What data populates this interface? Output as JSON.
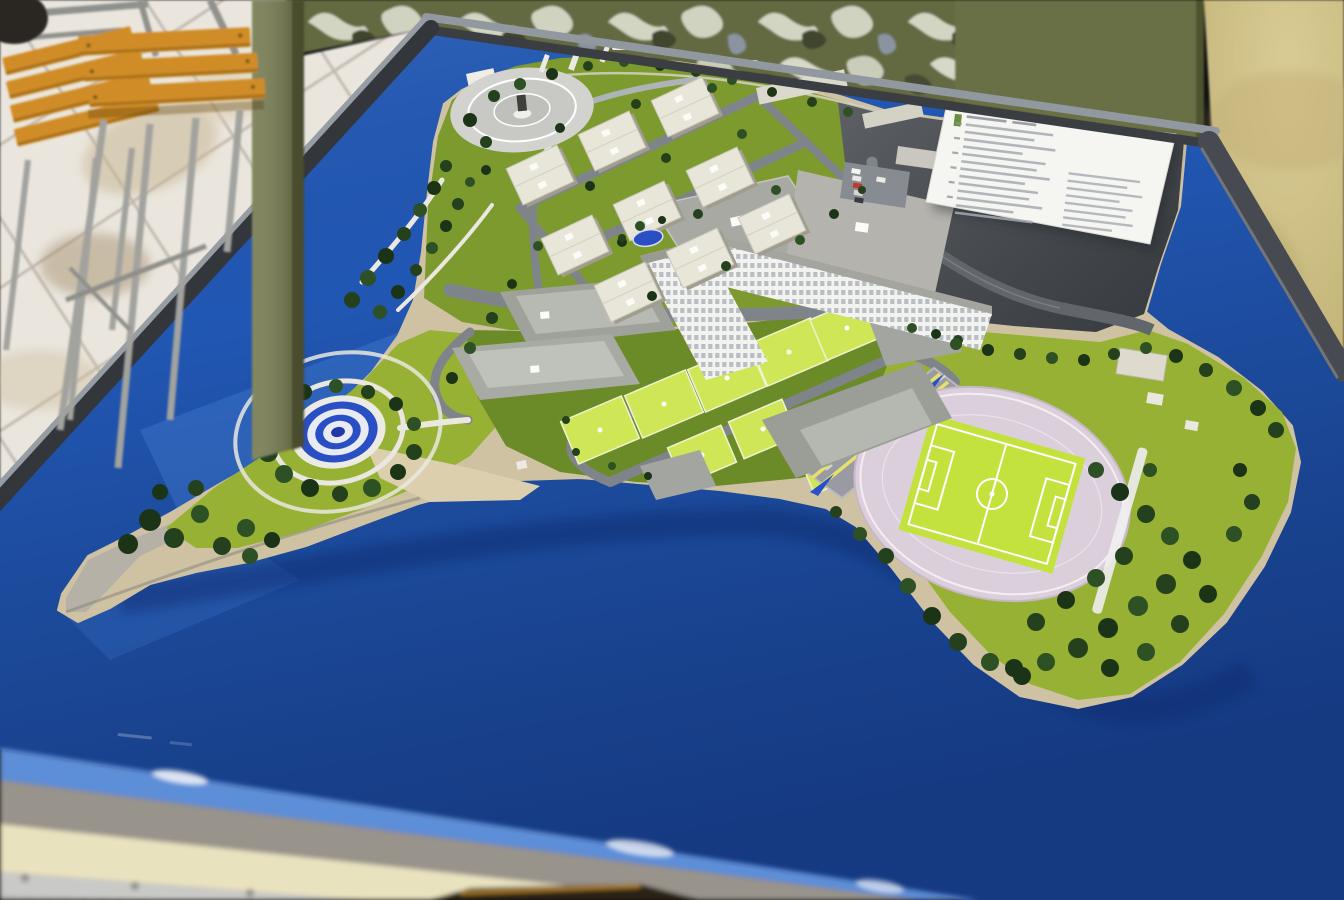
{
  "scene": {
    "type": "photograph",
    "subject": "architectural scale model of a coastal military campus displayed on a blue-topped exhibition table",
    "background_elements": [
      "camouflage curtain",
      "olive wall panel",
      "wooden folding stools",
      "tiled floor",
      "beige floor"
    ],
    "model_features": {
      "water": "deep blue bay surrounding a peninsula",
      "parade_circle": "light gray circular plaza with central monument",
      "fountain": "circular pool with concentric blue and white rings, ringed by trees",
      "stadium": "oval running track with bright green soccer pitch and white markings",
      "drill_strip": "straight gray track with yellow lane lines and blue direction arrows",
      "legend_card": "white tilted information card with fine illegible text rows",
      "barracks_count": 9,
      "sports_courts_count": 9,
      "headquarters_slabs": 2,
      "large_halls": 4,
      "piers_count": 3,
      "boats_count": 5,
      "parked_cars_count": 6
    }
  },
  "palette": {
    "water": "#2157b4",
    "water_glint": "#eef3fa",
    "land_sand": "#cfc2a3",
    "quay": "#b6b1a7",
    "grass_bright": "#97b134",
    "grass_mid": "#7d9a2e",
    "grass_dark": "#6b8a28",
    "court": "#cfe657",
    "pitch": "#c3e23e",
    "track": "#dccfdc",
    "asphalt": "#4c5055",
    "road": "#7f848b",
    "path": "#eae8e0",
    "roof_light": "#e8e5d9",
    "roof_gray": "#a9a9a3",
    "facade": "#f2f2ee",
    "fountain_blue": "#2a4fc4",
    "arrow_blue": "#2a50c8",
    "lane_yellow": "#e8e06a",
    "camo_base": "#646b43",
    "olive_panel": "#6b7045",
    "pole": "#6e7346",
    "tan_floor": "#cec083",
    "floor_tile": "#eae6de",
    "wood": "#d08c28",
    "frame_dark": "#3a3e43",
    "bevel_blue": "#5d8ed8",
    "apron": "#98938b",
    "cream": "#e9e2bf",
    "silver": "#c9c9c7",
    "card": "#f5f5f1",
    "legend_green": "#6a8f3a"
  }
}
